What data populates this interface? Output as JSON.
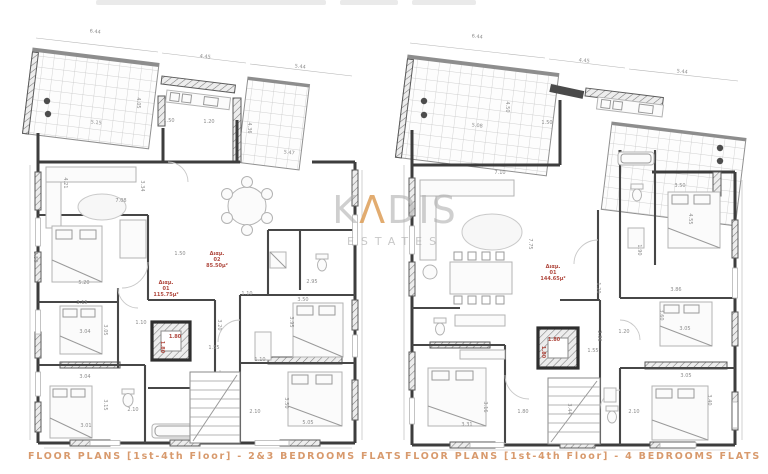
{
  "watermark": {
    "k": "K",
    "a": "Λ",
    "dis": "DIS",
    "sub": "ESTATES"
  },
  "plans": [
    {
      "caption": "FLOOR PLANS [1st-4th Floor] - 2&3 BEDROOMS FLATS",
      "labels": [
        {
          "x": 95,
          "y": 33,
          "t": "6.44",
          "r": 7
        },
        {
          "x": 205,
          "y": 58,
          "t": "4.45",
          "r": 7
        },
        {
          "x": 300,
          "y": 68,
          "t": "5.44",
          "r": 7
        },
        {
          "x": 137,
          "y": 103,
          "t": "4.05",
          "r": 90
        },
        {
          "x": 96,
          "y": 124,
          "t": "5.15",
          "r": 7
        },
        {
          "x": 169,
          "y": 122,
          "t": "1.50"
        },
        {
          "x": 209,
          "y": 123,
          "t": "1.20"
        },
        {
          "x": 248,
          "y": 128,
          "t": "4.36",
          "r": 90
        },
        {
          "x": 289,
          "y": 154,
          "t": "5.47",
          "r": 7
        },
        {
          "x": 64,
          "y": 183,
          "t": "4.21",
          "r": 90
        },
        {
          "x": 141,
          "y": 186,
          "t": "3.34",
          "r": 90
        },
        {
          "x": 121,
          "y": 202,
          "t": "7.08"
        },
        {
          "x": 34,
          "y": 257,
          "t": "5.50",
          "r": 90
        },
        {
          "x": 180,
          "y": 255,
          "t": "1.50"
        },
        {
          "x": 84,
          "y": 284,
          "t": "5.20"
        },
        {
          "x": 82,
          "y": 304,
          "t": "3.15"
        },
        {
          "x": 104,
          "y": 330,
          "t": "3.05",
          "r": 90
        },
        {
          "x": 85,
          "y": 333,
          "t": "3.04"
        },
        {
          "x": 141,
          "y": 324,
          "t": "1.10"
        },
        {
          "x": 175,
          "y": 338,
          "t": "1.80",
          "red": 1
        },
        {
          "x": 161,
          "y": 347,
          "t": "1.80",
          "r": 90,
          "red": 1
        },
        {
          "x": 85,
          "y": 378,
          "t": "3.04"
        },
        {
          "x": 104,
          "y": 405,
          "t": "3.15",
          "r": 90
        },
        {
          "x": 133,
          "y": 411,
          "t": "2.10"
        },
        {
          "x": 86,
          "y": 427,
          "t": "3.01"
        },
        {
          "x": 247,
          "y": 295,
          "t": "1.10"
        },
        {
          "x": 312,
          "y": 283,
          "t": "2.95"
        },
        {
          "x": 303,
          "y": 301,
          "t": "3.50"
        },
        {
          "x": 290,
          "y": 322,
          "t": "3.95",
          "r": 90
        },
        {
          "x": 218,
          "y": 325,
          "t": "3.20",
          "r": 90
        },
        {
          "x": 214,
          "y": 349,
          "t": "1.55"
        },
        {
          "x": 260,
          "y": 361,
          "t": "1.10"
        },
        {
          "x": 285,
          "y": 403,
          "t": "3.50",
          "r": 90
        },
        {
          "x": 255,
          "y": 413,
          "t": "2.10"
        },
        {
          "x": 308,
          "y": 424,
          "t": "5.05"
        },
        {
          "x": 166,
          "y": 284,
          "t": "Διαμ.",
          "red": 1
        },
        {
          "x": 166,
          "y": 290,
          "t": "01",
          "red": 1
        },
        {
          "x": 166,
          "y": 296,
          "t": "115.75μ²",
          "red": 1
        },
        {
          "x": 217,
          "y": 255,
          "t": "Διαμ.",
          "red": 1
        },
        {
          "x": 217,
          "y": 261,
          "t": "02",
          "red": 1
        },
        {
          "x": 217,
          "y": 267,
          "t": "85.50μ²",
          "red": 1
        }
      ]
    },
    {
      "caption": "FLOOR PLANS [1st-4th Floor] - 4 BEDROOMS FLATS",
      "labels": [
        {
          "x": 477,
          "y": 38,
          "t": "6.44",
          "r": 7
        },
        {
          "x": 584,
          "y": 62,
          "t": "4.45",
          "r": 7
        },
        {
          "x": 682,
          "y": 73,
          "t": "5.44",
          "r": 7
        },
        {
          "x": 477,
          "y": 127,
          "t": "5.08",
          "r": 7
        },
        {
          "x": 506,
          "y": 107,
          "t": "4.50",
          "r": 90
        },
        {
          "x": 547,
          "y": 124,
          "t": "1.50"
        },
        {
          "x": 500,
          "y": 174,
          "t": "7.10"
        },
        {
          "x": 529,
          "y": 244,
          "t": "7.75",
          "r": 90
        },
        {
          "x": 680,
          "y": 187,
          "t": "3.50"
        },
        {
          "x": 689,
          "y": 219,
          "t": "4.55",
          "r": 90
        },
        {
          "x": 638,
          "y": 250,
          "t": "1.90",
          "r": 90
        },
        {
          "x": 597,
          "y": 288,
          "t": "1.20",
          "r": 90
        },
        {
          "x": 676,
          "y": 291,
          "t": "3.86"
        },
        {
          "x": 660,
          "y": 315,
          "t": "3.60",
          "r": 90
        },
        {
          "x": 624,
          "y": 333,
          "t": "1.20"
        },
        {
          "x": 598,
          "y": 336,
          "t": "2.86",
          "r": 90
        },
        {
          "x": 685,
          "y": 330,
          "t": "3.05"
        },
        {
          "x": 593,
          "y": 352,
          "t": "1.55"
        },
        {
          "x": 686,
          "y": 377,
          "t": "3.05"
        },
        {
          "x": 708,
          "y": 400,
          "t": "3.40",
          "r": 90
        },
        {
          "x": 634,
          "y": 413,
          "t": "2.10"
        },
        {
          "x": 554,
          "y": 341,
          "t": "1.80",
          "red": 1
        },
        {
          "x": 542,
          "y": 352,
          "t": "1.80",
          "r": 90,
          "red": 1
        },
        {
          "x": 484,
          "y": 407,
          "t": "3.16",
          "r": 90
        },
        {
          "x": 523,
          "y": 413,
          "t": "1.80"
        },
        {
          "x": 568,
          "y": 409,
          "t": "3.44",
          "r": 90
        },
        {
          "x": 467,
          "y": 426,
          "t": "3.31"
        },
        {
          "x": 553,
          "y": 268,
          "t": "Διαμ.",
          "red": 1
        },
        {
          "x": 553,
          "y": 274,
          "t": "01",
          "red": 1
        },
        {
          "x": 553,
          "y": 280,
          "t": "144.65μ²",
          "red": 1
        }
      ]
    }
  ]
}
